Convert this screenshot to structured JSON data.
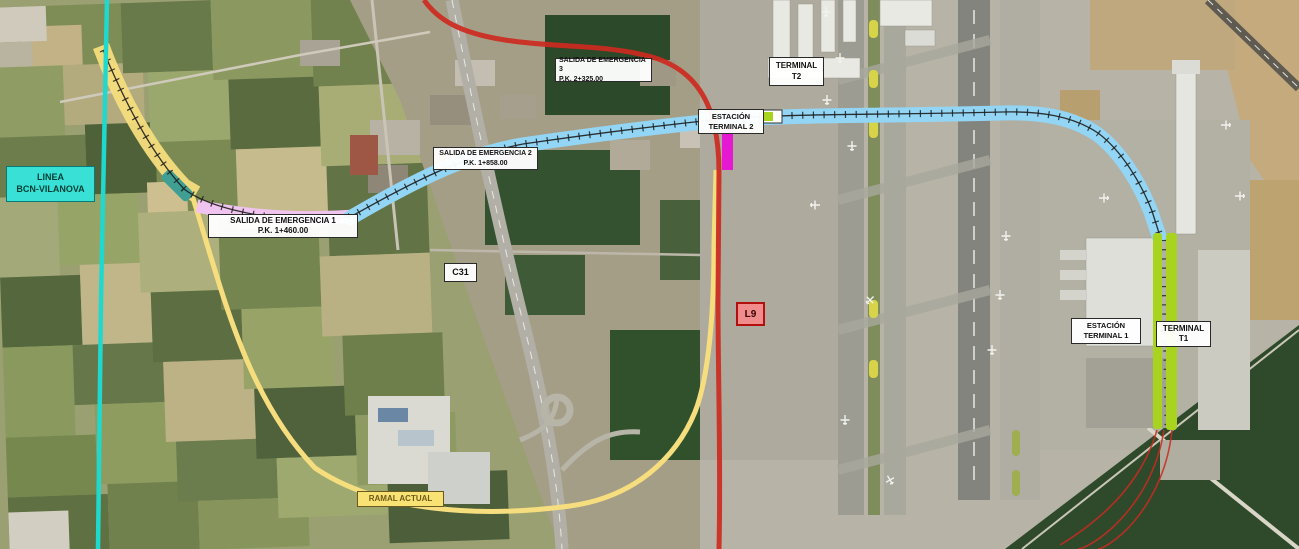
{
  "labels": {
    "linea_bcn_vilanova": {
      "line1": "LINEA",
      "line2": "BCN-VILANOVA"
    },
    "salida_emergencia_1": {
      "line1": "SALIDA DE EMERGENCIA 1",
      "line2": "P.K. 1+460.00"
    },
    "salida_emergencia_2": {
      "line1": "SALIDA DE EMERGENCIA 2",
      "line2": "P.K. 1+858.00"
    },
    "salida_emergencia_3": {
      "line1": "SALIDA DE EMERGENCIA 3",
      "line2": "P.K. 2+325.00"
    },
    "estacion_terminal_2": {
      "line1": "ESTACIÓN",
      "line2": "TERMINAL 2"
    },
    "terminal_t2": {
      "line1": "TERMINAL",
      "line2": "T2"
    },
    "estacion_terminal_1": {
      "line1": "ESTACIÓN",
      "line2": "TERMINAL 1"
    },
    "terminal_t1": {
      "line1": "TERMINAL",
      "line2": "T1"
    },
    "ramal_actual": {
      "text": "RAMAL ACTUAL"
    },
    "c31": {
      "text": "C31"
    },
    "l9": {
      "text": "L9"
    }
  },
  "colors": {
    "linea_bcn_vilanova": "#1fd9cf",
    "bcn_label_bg": "#38e0d6",
    "ramal_actual": "#f6dd7d",
    "ramal_label_bg": "#f8e273",
    "new_line_tunnel": "#93d5f4",
    "cut_and_cover_section": "#f0c4ef",
    "portal_structure": "#3f9f93",
    "station_terminal_2": "#e619d3",
    "station_terminal_1": "#a8d41f",
    "l9_line": "#cd2a20",
    "l9_label_bg": "#f08c8c",
    "l9_label_border": "#b40f0f",
    "track": "#1d1d1d"
  }
}
